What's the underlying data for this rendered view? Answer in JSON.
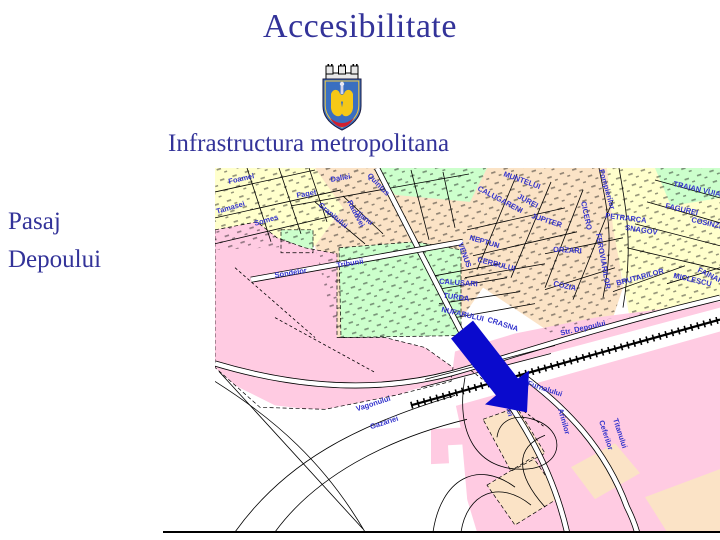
{
  "slide": {
    "title": "Accesibilitate",
    "subtitle": "Infrastructura metropolitana",
    "side_label": {
      "line1": "Pasaj",
      "line2": "Depoului"
    },
    "colors": {
      "heading": "#333399",
      "map_label": "#3333CC",
      "arrow": "#0A0ACD",
      "pink": "#FFCBE2",
      "green": "#CCFFCC",
      "cream": "#FFFFCC",
      "peach": "#FBE3C6"
    }
  },
  "map": {
    "street_labels": [
      {
        "text": "Foamei",
        "x": 14,
        "y": 16,
        "r": -13
      },
      {
        "text": "Tamasei",
        "x": 2,
        "y": 46,
        "r": -16
      },
      {
        "text": "Somes",
        "x": 40,
        "y": 58,
        "r": -16
      },
      {
        "text": "Faget",
        "x": 82,
        "y": 30,
        "r": -10
      },
      {
        "text": "Daliei",
        "x": 116,
        "y": 14,
        "r": -10
      },
      {
        "text": "Granitului",
        "x": 103,
        "y": 38,
        "r": 40
      },
      {
        "text": "Quintus",
        "x": 152,
        "y": 8,
        "r": 46
      },
      {
        "text": "Radovei",
        "x": 132,
        "y": 34,
        "r": 62
      },
      {
        "text": "Jianu",
        "x": 140,
        "y": 46,
        "r": 36
      },
      {
        "text": "Sondelor",
        "x": 60,
        "y": 110,
        "r": -9
      },
      {
        "text": "Tribunii",
        "x": 122,
        "y": 100,
        "r": -9
      },
      {
        "text": "VENUS",
        "x": 243,
        "y": 76,
        "r": 70
      },
      {
        "text": "MUNTELUI",
        "x": 288,
        "y": 8,
        "r": 20
      },
      {
        "text": "CALUGARENI",
        "x": 262,
        "y": 22,
        "r": 28
      },
      {
        "text": "JUREI",
        "x": 302,
        "y": 30,
        "r": 28
      },
      {
        "text": "JUPITER",
        "x": 316,
        "y": 50,
        "r": 18
      },
      {
        "text": "NEPTUN",
        "x": 254,
        "y": 72,
        "r": 16
      },
      {
        "text": "CERBULUI",
        "x": 262,
        "y": 94,
        "r": 14
      },
      {
        "text": "FAINARI",
        "x": 482,
        "y": 104,
        "r": 26
      },
      {
        "text": "CALUSARI",
        "x": 224,
        "y": 116,
        "r": 4
      },
      {
        "text": "TURDA",
        "x": 228,
        "y": 130,
        "r": 8
      },
      {
        "text": "NUFARULUI",
        "x": 226,
        "y": 144,
        "r": 13
      },
      {
        "text": "CRASNA",
        "x": 272,
        "y": 154,
        "r": 18
      },
      {
        "text": "ORZARI",
        "x": 338,
        "y": 84,
        "r": 3
      },
      {
        "text": "COZIA",
        "x": 338,
        "y": 118,
        "r": 13
      },
      {
        "text": "PETRARCA",
        "x": 390,
        "y": 50,
        "r": 7
      },
      {
        "text": "SNAGOV",
        "x": 410,
        "y": 62,
        "r": 9
      },
      {
        "text": "TRAIAN VUIA",
        "x": 458,
        "y": 18,
        "r": 13
      },
      {
        "text": "FAGUREI",
        "x": 450,
        "y": 40,
        "r": 13
      },
      {
        "text": "COSINZENEI",
        "x": 476,
        "y": 54,
        "r": 13
      },
      {
        "text": "Pompierilor",
        "x": 384,
        "y": 2,
        "r": 74
      },
      {
        "text": "CICERO",
        "x": 366,
        "y": 34,
        "r": 78
      },
      {
        "text": "FEROVIARILOR",
        "x": 381,
        "y": 66,
        "r": 80
      },
      {
        "text": "BRUTARILOR",
        "x": 402,
        "y": 118,
        "r": -15
      },
      {
        "text": "MICLESCU",
        "x": 458,
        "y": 110,
        "r": 13
      },
      {
        "text": "Str. Depoului",
        "x": 346,
        "y": 168,
        "r": -13
      },
      {
        "text": "Vagonului",
        "x": 142,
        "y": 244,
        "r": -18
      },
      {
        "text": "Gazariei",
        "x": 156,
        "y": 262,
        "r": -18
      },
      {
        "text": "Furnalului",
        "x": 312,
        "y": 218,
        "r": 18
      },
      {
        "text": "Haltei",
        "x": 288,
        "y": 230,
        "r": 74
      },
      {
        "text": "Arinilor",
        "x": 343,
        "y": 242,
        "r": 74
      },
      {
        "text": "Ceferilor",
        "x": 384,
        "y": 254,
        "r": 72
      },
      {
        "text": "Titanului",
        "x": 398,
        "y": 252,
        "r": 72
      }
    ]
  }
}
